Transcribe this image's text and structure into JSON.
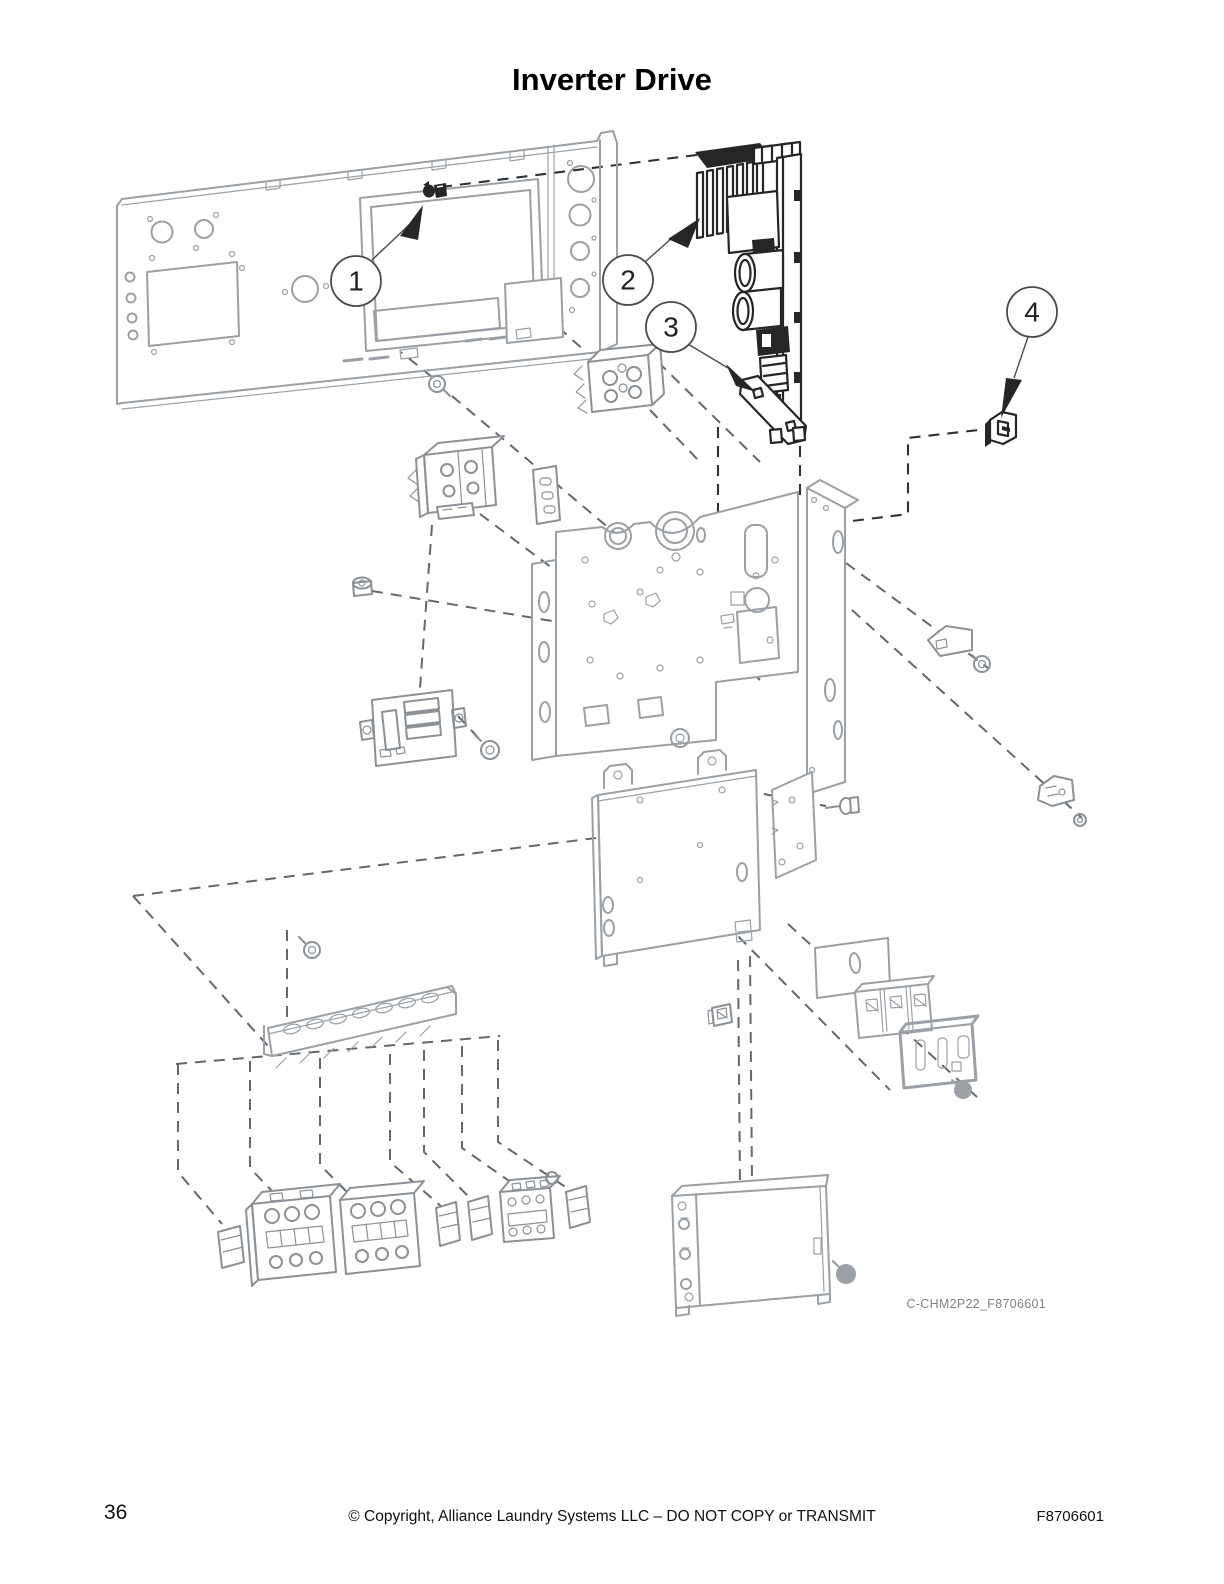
{
  "page": {
    "title": "Inverter Drive",
    "diagram_code": "C-CHM2P22_F8706601",
    "callouts": [
      {
        "label": "1"
      },
      {
        "label": "2"
      },
      {
        "label": "3"
      },
      {
        "label": "4"
      }
    ],
    "footer": {
      "page_number": "36",
      "copyright_notice": "© Copyright, Alliance Laundry Systems LLC – DO NOT COPY or TRANSMIT",
      "document_number": "F8706601"
    },
    "colors": {
      "background": "#ffffff",
      "part_outline_gray": "#9aa0a5",
      "part_outline_dark": "#262626",
      "dashed_line": "#62686d",
      "diagram_code_text": "#7e8286",
      "text": "#000000"
    }
  }
}
